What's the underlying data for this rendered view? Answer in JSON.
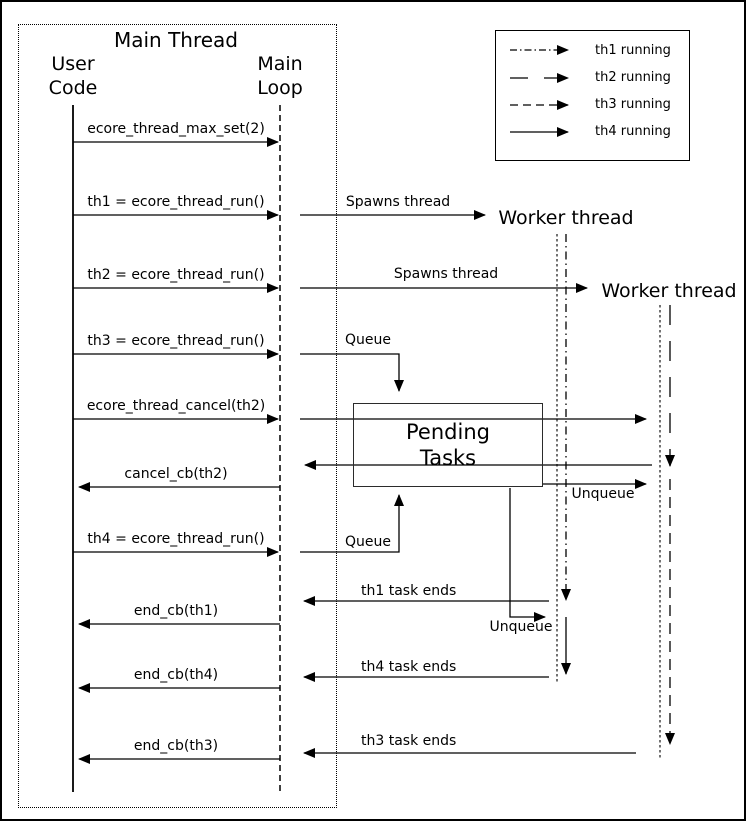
{
  "title": "Main Thread",
  "lifelines": {
    "user_code": "User Code",
    "main_loop": "Main Loop",
    "worker1": "Worker thread",
    "worker2": "Worker thread"
  },
  "pending_box": "Pending Tasks",
  "legend": [
    {
      "label": "th1 running",
      "line_style": "dash-dot"
    },
    {
      "label": "th2 running",
      "line_style": "long-dash"
    },
    {
      "label": "th3 running",
      "line_style": "dashed"
    },
    {
      "label": "th4 running",
      "line_style": "solid"
    }
  ],
  "messages": {
    "max_set": "ecore_thread_max_set(2)",
    "th1_run": "th1 = ecore_thread_run()",
    "th2_run": "th2 = ecore_thread_run()",
    "th3_run": "th3 = ecore_thread_run()",
    "cancel_th2": "ecore_thread_cancel(th2)",
    "cancel_cb": "cancel_cb(th2)",
    "th4_run": "th4 = ecore_thread_run()",
    "end_cb_th1": "end_cb(th1)",
    "end_cb_th4": "end_cb(th4)",
    "end_cb_th3": "end_cb(th3)",
    "spawns1": "Spawns thread",
    "spawns2": "Spawns thread",
    "queue1": "Queue",
    "queue2": "Queue",
    "unqueue1": "Unqueue",
    "unqueue2": "Unqueue",
    "th1_ends": "th1 task ends",
    "th4_ends": "th4 task ends",
    "th3_ends": "th3 task ends"
  },
  "colors": {
    "ink": "#000000",
    "background": "#ffffff"
  }
}
